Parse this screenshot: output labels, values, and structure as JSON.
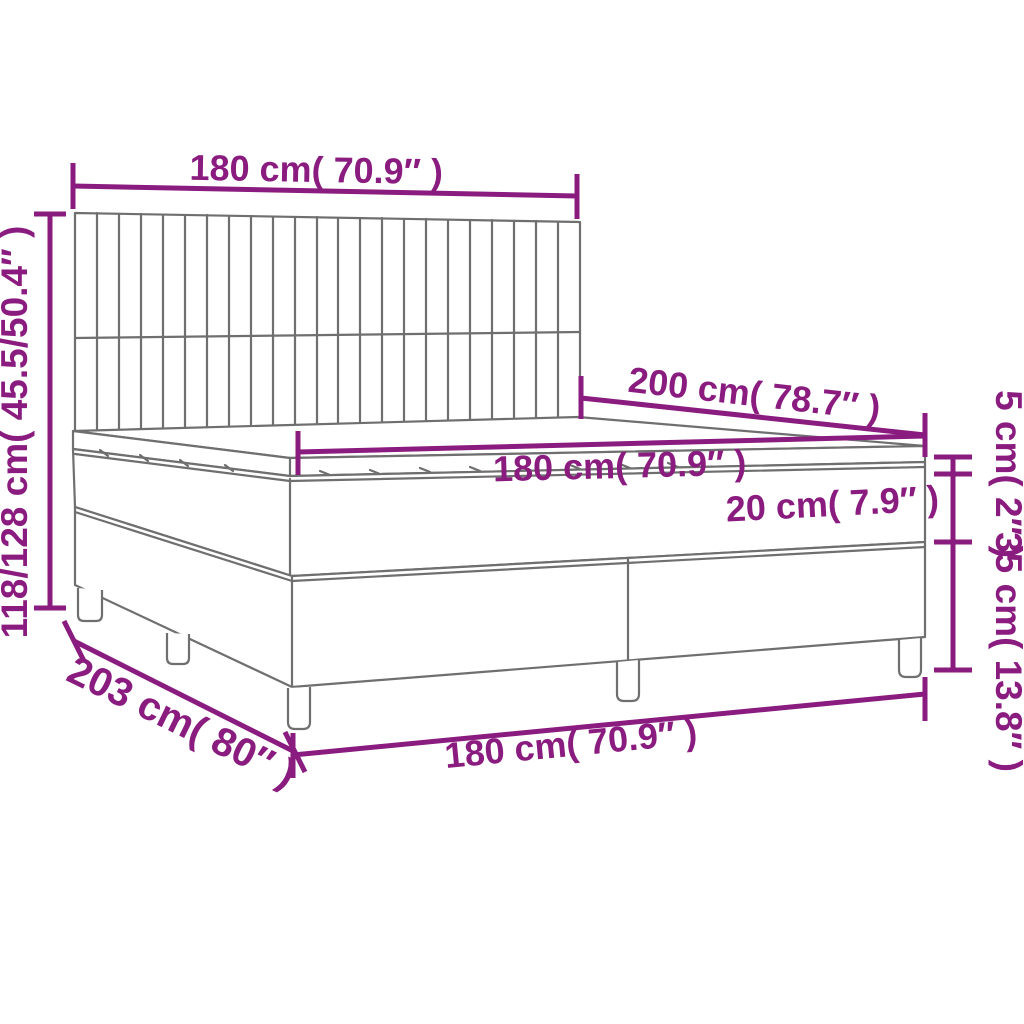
{
  "diagram": {
    "title": "box-spring-bed-dimension-diagram",
    "labels": {
      "headboard_width": "180 cm( 70.9″ )",
      "total_height": "118/128 cm( 45.5/50.4″ )",
      "bed_length": "200 cm( 78.7″ )",
      "mattress_width": "180 cm( 70.9″ )",
      "mattress_height": "20 cm( 7.9″ )",
      "topper_height": "5 cm( 2″ )",
      "base_height": "35 cm( 13.8″ )",
      "total_length": "203 cm( 80″ )",
      "base_width": "180 cm( 70.9″ )"
    },
    "colors": {
      "dimension": "#8A1B7F",
      "artwork": "#6F6F6F",
      "background": "#FFFFFF"
    }
  }
}
